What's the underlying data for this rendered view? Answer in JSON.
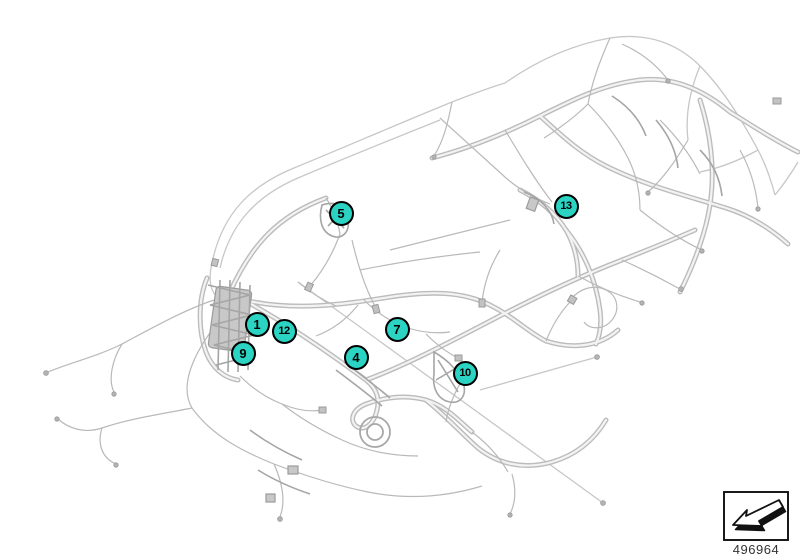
{
  "page": {
    "background": "#ffffff"
  },
  "colors": {
    "callout_fill": "#2bd3c3",
    "callout_border": "#000000",
    "callout_text": "#000000",
    "harness_line": "#c3c3c3"
  },
  "callouts": [
    {
      "label": "5",
      "x": 341,
      "y": 213
    },
    {
      "label": "13",
      "x": 566,
      "y": 206
    },
    {
      "label": "1",
      "x": 257,
      "y": 324
    },
    {
      "label": "12",
      "x": 284,
      "y": 331
    },
    {
      "label": "9",
      "x": 243,
      "y": 353
    },
    {
      "label": "4",
      "x": 356,
      "y": 357
    },
    {
      "label": "7",
      "x": 397,
      "y": 329
    },
    {
      "label": "10",
      "x": 465,
      "y": 373
    }
  ],
  "footer": {
    "part_number": "496964",
    "icon": "change-pointer-arrow-icon"
  }
}
